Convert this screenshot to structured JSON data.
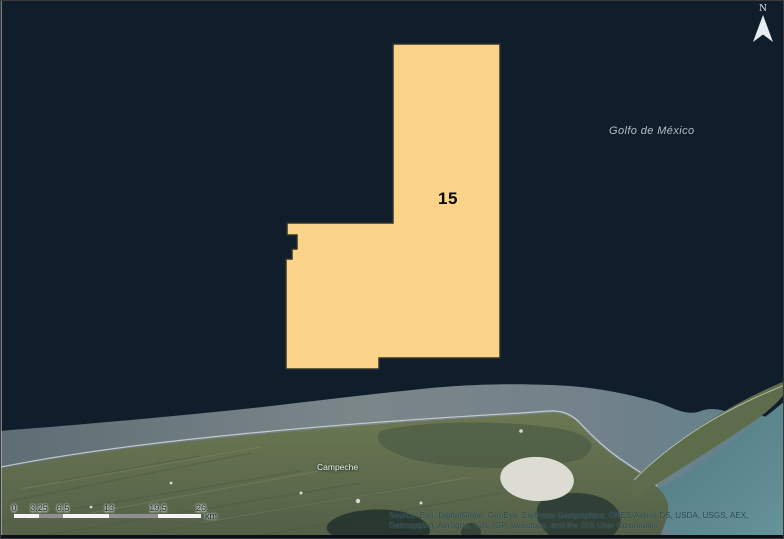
{
  "map": {
    "water_label": "Golfo de México",
    "place_label": "Campeche",
    "north_label": "N",
    "block": {
      "number": "15",
      "fill_color": "#FBD489",
      "outline_color": "#32322a"
    },
    "colors": {
      "ocean": "#101e2b",
      "coastal_water": "#6d7a7e",
      "land_green": "#66744f",
      "turquoise_water": "#55808a",
      "sand": "#e3e3da"
    }
  },
  "scalebar": {
    "ticks": [
      "0",
      "3.25",
      "6.5",
      "13",
      "19.5",
      "26"
    ],
    "unit": "km"
  },
  "attribution": {
    "line1": "Source: Esri, DigitalGlobe, GeoEye, Earthstar Geographics, CNES/Airbus DS, USDA, USGS, AEX,",
    "line2": "Getmapping, Aerogrid, IGN, IGP, swisstopo, and the GIS User Community"
  }
}
